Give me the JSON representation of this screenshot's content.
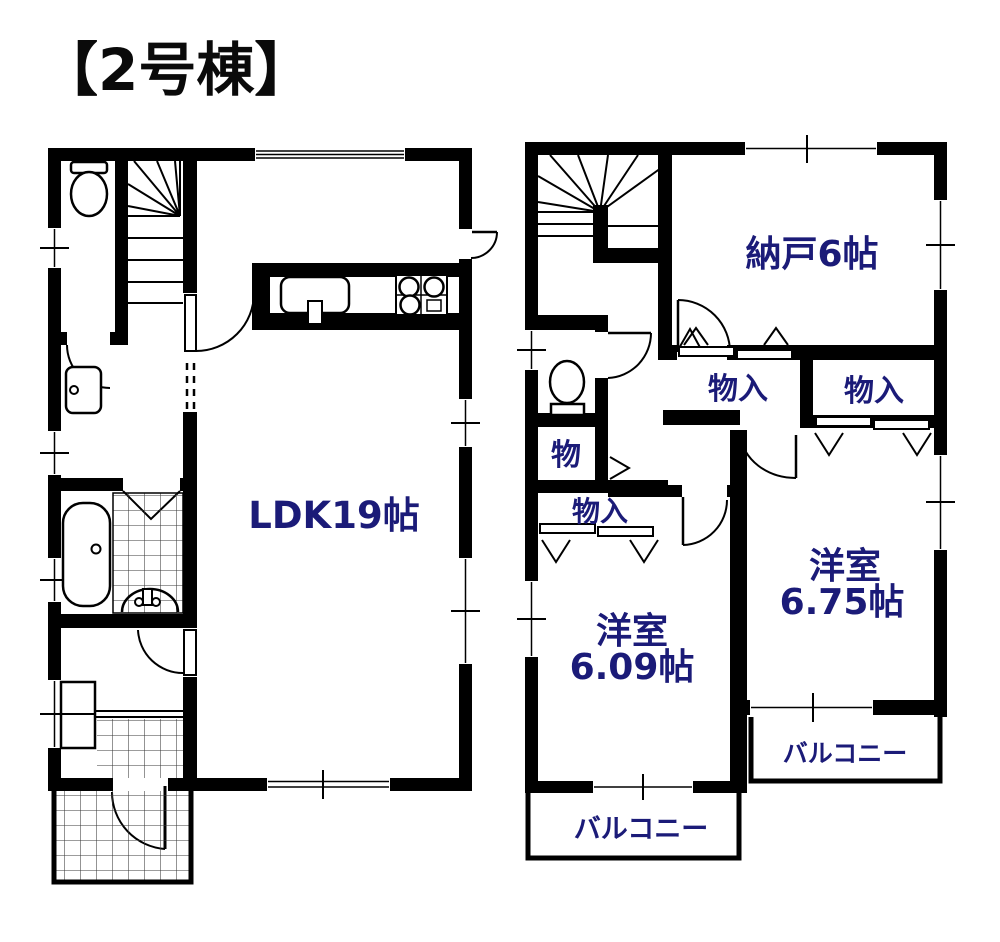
{
  "title": "【2号棟】",
  "colors": {
    "ink": "#000000",
    "label_navy": "#1b1b78",
    "background": "#ffffff"
  },
  "floor1": {
    "ldk": "LDK19帖"
  },
  "floor2": {
    "storage_room": "納戸6帖",
    "bedroom_east_name": "洋室",
    "bedroom_east_size": "6.75帖",
    "bedroom_west_name": "洋室",
    "bedroom_west_size": "6.09帖",
    "closet_hall_west": "物入",
    "closet_hall_east": "物入",
    "closet_small": "物",
    "closet_bedroom_west": "物入",
    "balcony_south": "バルコニー",
    "balcony_east": "バルコニー"
  }
}
